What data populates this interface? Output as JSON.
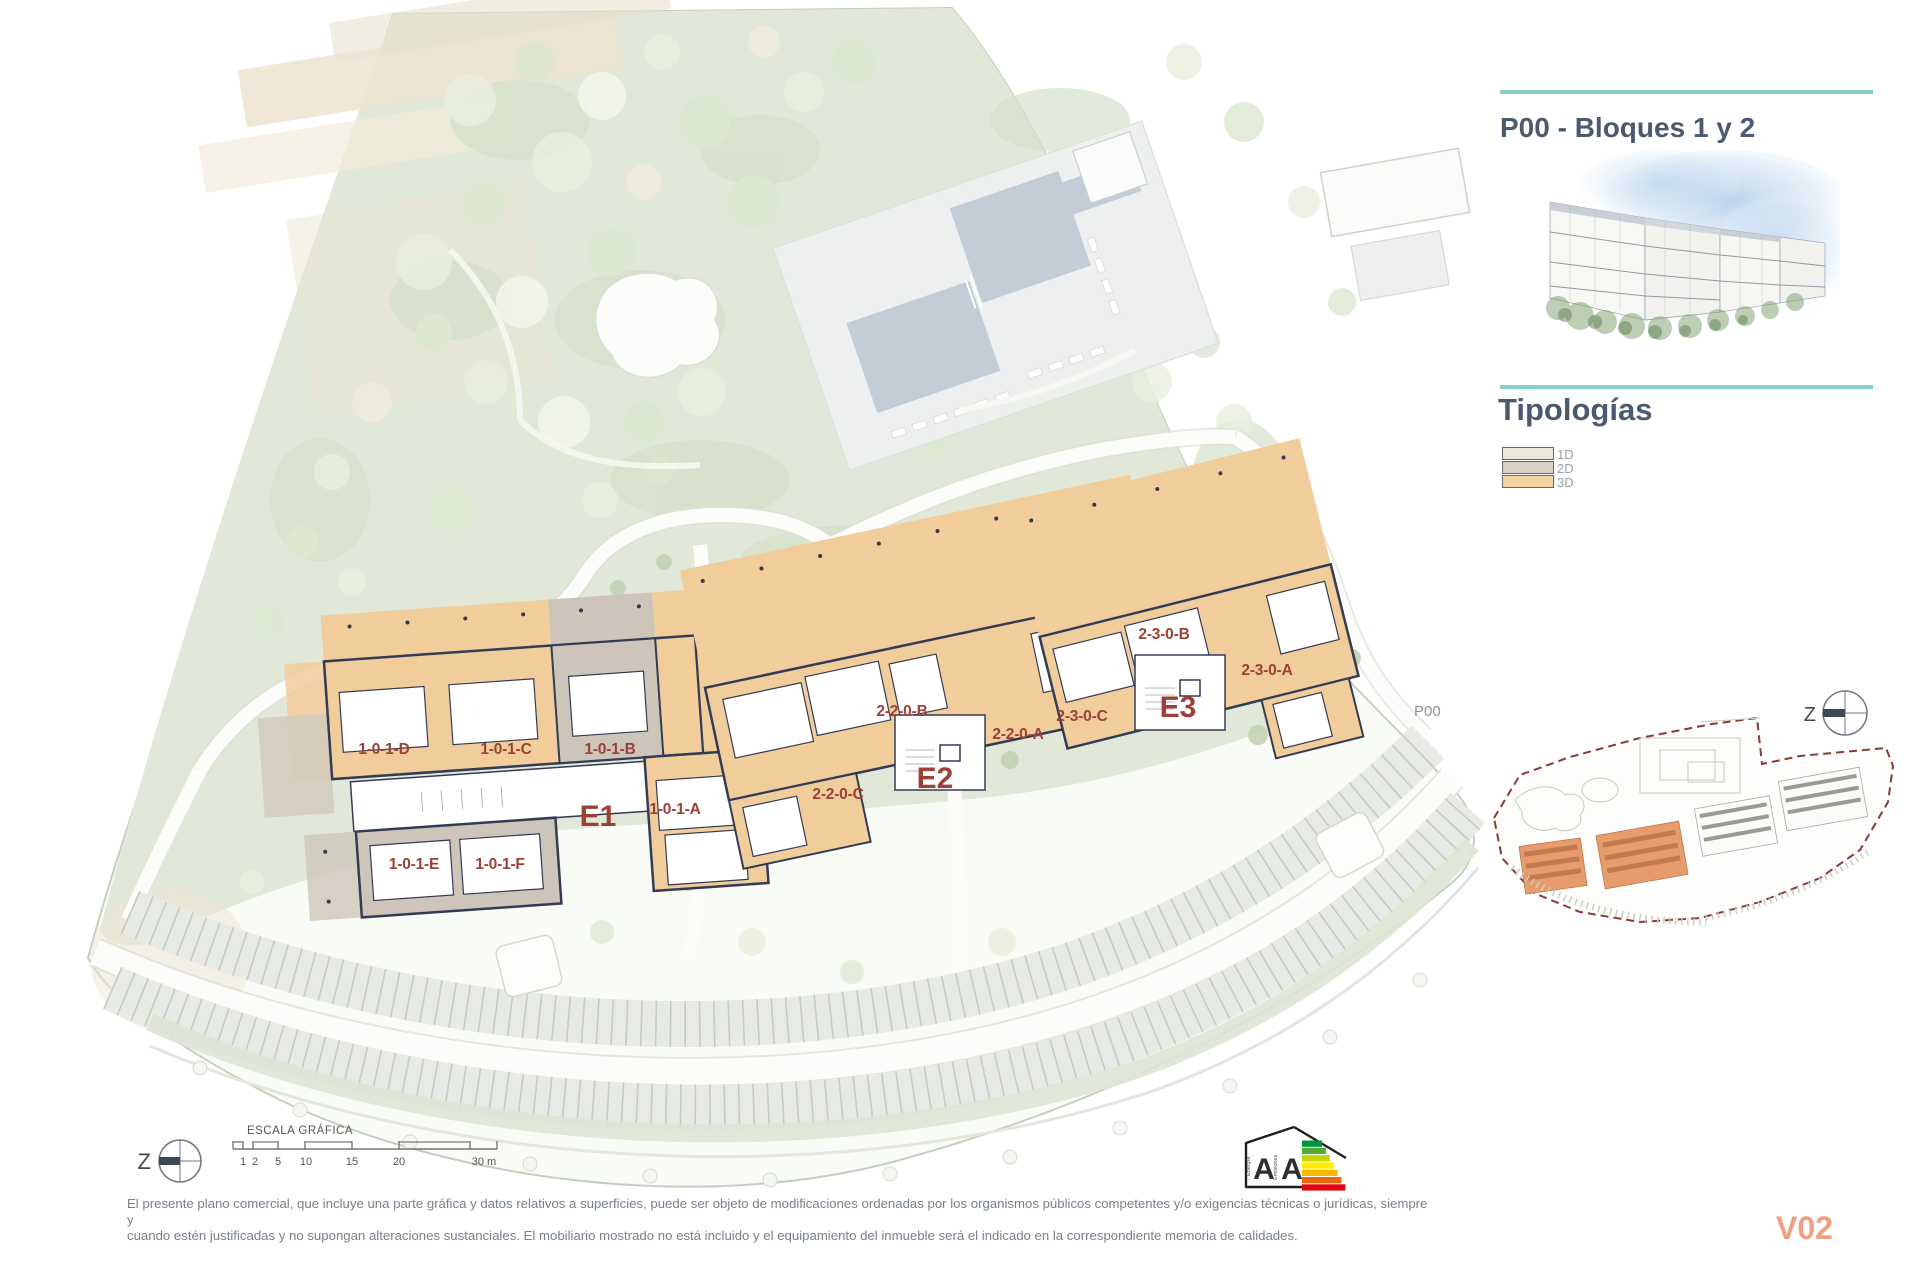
{
  "header": {
    "title": "P00 - Bloques 1 y 2",
    "accent_color": "#7fd2cd",
    "title_color": "#4a5b70"
  },
  "typologies": {
    "heading": "Tipologías",
    "items": [
      {
        "label": "1D",
        "color": "#e9e9da"
      },
      {
        "label": "2D",
        "color": "#d8d1c5"
      },
      {
        "label": "3D",
        "color": "#f6d4a1"
      }
    ]
  },
  "minimap": {
    "label": "P00",
    "highlight_color": "#e89c6e",
    "boundary_color": "#8a3a34"
  },
  "north": {
    "letter": "Z"
  },
  "scalebar": {
    "title": "ESCALA GRÁFICA",
    "ticks": [
      {
        "label": "1",
        "x": 243
      },
      {
        "label": "2",
        "x": 255
      },
      {
        "label": "5",
        "x": 278
      },
      {
        "label": "10",
        "x": 306
      },
      {
        "label": "15",
        "x": 352
      },
      {
        "label": "20",
        "x": 399
      },
      {
        "label": "30 m",
        "x": 484
      }
    ]
  },
  "plan": {
    "label_color": "#9c4137",
    "block_labels": [
      {
        "text": "E1",
        "x": 598,
        "y": 826
      },
      {
        "text": "E2",
        "x": 935,
        "y": 788
      },
      {
        "text": "E3",
        "x": 1178,
        "y": 717
      }
    ],
    "unit_labels": [
      {
        "text": "1-0-1-D",
        "x": 384,
        "y": 754
      },
      {
        "text": "1-0-1-C",
        "x": 506,
        "y": 754
      },
      {
        "text": "1-0-1-B",
        "x": 610,
        "y": 754
      },
      {
        "text": "1-0-1-A",
        "x": 675,
        "y": 814
      },
      {
        "text": "1-0-1-E",
        "x": 414,
        "y": 869
      },
      {
        "text": "1-0-1-F",
        "x": 500,
        "y": 869
      },
      {
        "text": "2-2-0-B",
        "x": 902,
        "y": 716
      },
      {
        "text": "2-2-0-A",
        "x": 1018,
        "y": 739
      },
      {
        "text": "2-2-0-C",
        "x": 838,
        "y": 799
      },
      {
        "text": "2-3-0-C",
        "x": 1082,
        "y": 721
      },
      {
        "text": "2-3-0-B",
        "x": 1164,
        "y": 639
      },
      {
        "text": "2-3-0-A",
        "x": 1267,
        "y": 675
      }
    ]
  },
  "energy": {
    "letters": [
      "A",
      "A"
    ],
    "scales": [
      "Energía",
      "Emisiones"
    ],
    "bars": [
      "#009640",
      "#52ae32",
      "#c8d400",
      "#ffed00",
      "#fbba00",
      "#ec6608",
      "#e30613"
    ]
  },
  "footer": {
    "line1": "El presente plano comercial, que incluye una parte gráfica y datos relativos a superficies, puede ser objeto de modificaciones ordenadas por los organismos públicos competentes y/o exigencias técnicas o jurídicas, siempre y",
    "line2": "cuando estén justificadas y no supongan alteraciones sustanciales. El mobiliario mostrado no está incluido y el equipamiento del inmueble será el indicado en la correspondiente memoria de calidades.",
    "version": "V02",
    "version_color": "#f0a080"
  }
}
